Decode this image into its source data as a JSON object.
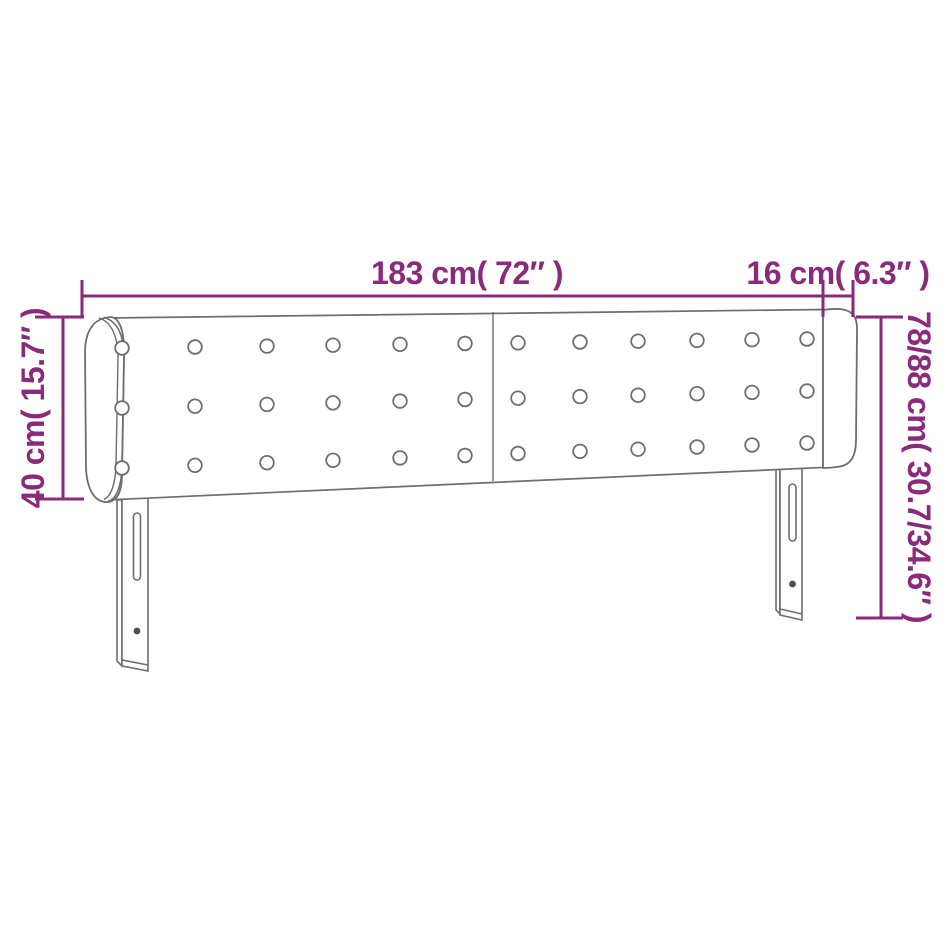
{
  "page": {
    "background": "#ffffff",
    "kind": "product dimension diagram",
    "product": "upholstered headboard with side ears, button tufting and two adjustable leg posts"
  },
  "diagram": {
    "accent_color": "#8A2A7B",
    "outline_color": "#6E6E6E",
    "labels": {
      "width": "183 cm( 72″ )",
      "ear": "16 cm( 6.3″ )",
      "side_height": "40 cm( 15.7″ )",
      "total_height": "78/88 cm( 30.7/34.6″ )"
    },
    "values": {
      "width_cm": "183",
      "width_inch": "72",
      "ear_cm": "16",
      "ear_inch": "6.3",
      "side_height_cm": "40",
      "side_height_inch": "15.7",
      "total_height_cm": "78/88",
      "total_height_inch": "30.7/34.6"
    },
    "tufting": {
      "panels": 2,
      "rows": 3,
      "columns_per_panel": 6
    }
  }
}
